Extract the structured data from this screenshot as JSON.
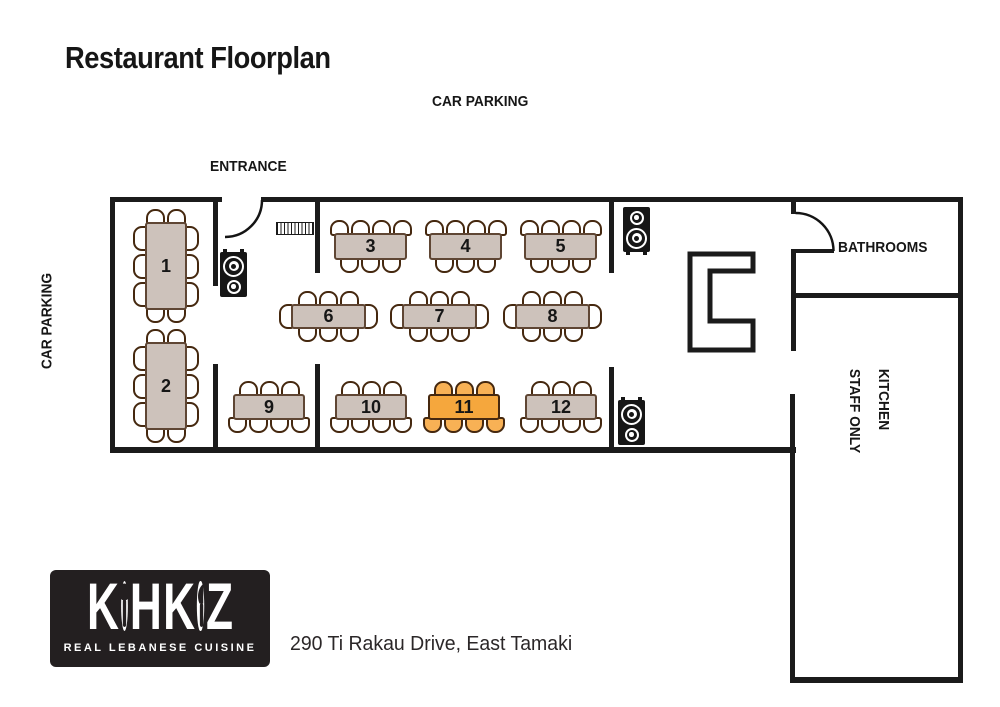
{
  "page": {
    "title": "Restaurant Floorplan",
    "address": "290 Ti Rakau Drive, East Tamaki"
  },
  "labels": {
    "car_parking_top": "CAR PARKING",
    "car_parking_left": "CAR PARKING",
    "entrance": "ENTRANCE",
    "bathrooms": "BATHROOMS",
    "bar": "BAR",
    "kitchen_line1": "KITCHEN",
    "kitchen_line2": "STAFF ONLY"
  },
  "logo": {
    "name": "KOHKOZ",
    "tagline": "REAL LEBANESE CUISINE"
  },
  "colors": {
    "wall": "#1b1b1b",
    "door_arc": "#141414",
    "table_fill": "#cdc2bb",
    "table_border": "#5f4634",
    "chair_fill": "#ffffff",
    "chair_border": "#45280f",
    "highlight_table_fill": "#f5a73d",
    "highlight_chair_fill": "#f8b155",
    "highlight_border": "#45280f",
    "speaker_bg": "#161616",
    "logo_bg": "#231f20",
    "text": "#1c1c1c"
  },
  "floorplan": {
    "tables": [
      {
        "label": "1",
        "x": 145,
        "y": 222,
        "w": 42,
        "h": 88,
        "seats": {
          "top": 2,
          "bottom": 2,
          "left": 3,
          "right": 3
        },
        "highlighted": false
      },
      {
        "label": "2",
        "x": 145,
        "y": 342,
        "w": 42,
        "h": 88,
        "seats": {
          "top": 2,
          "bottom": 2,
          "left": 3,
          "right": 3
        },
        "highlighted": false
      },
      {
        "label": "3",
        "x": 334,
        "y": 233,
        "w": 73,
        "h": 27,
        "seats": {
          "top": 4,
          "bottom": 3,
          "left": 0,
          "right": 0
        },
        "highlighted": false
      },
      {
        "label": "4",
        "x": 429,
        "y": 233,
        "w": 73,
        "h": 27,
        "seats": {
          "top": 4,
          "bottom": 3,
          "left": 0,
          "right": 0
        },
        "highlighted": false
      },
      {
        "label": "5",
        "x": 524,
        "y": 233,
        "w": 73,
        "h": 27,
        "seats": {
          "top": 4,
          "bottom": 3,
          "left": 0,
          "right": 0
        },
        "highlighted": false
      },
      {
        "label": "6",
        "x": 291,
        "y": 304,
        "w": 75,
        "h": 25,
        "seats": {
          "top": 3,
          "bottom": 3,
          "left": 1,
          "right": 1
        },
        "highlighted": false
      },
      {
        "label": "7",
        "x": 402,
        "y": 304,
        "w": 75,
        "h": 25,
        "seats": {
          "top": 3,
          "bottom": 3,
          "left": 1,
          "right": 1
        },
        "highlighted": false
      },
      {
        "label": "8",
        "x": 515,
        "y": 304,
        "w": 75,
        "h": 25,
        "seats": {
          "top": 3,
          "bottom": 3,
          "left": 1,
          "right": 1
        },
        "highlighted": false
      },
      {
        "label": "9",
        "x": 233,
        "y": 394,
        "w": 72,
        "h": 26,
        "seats": {
          "top": 3,
          "bottom": 4,
          "left": 0,
          "right": 0
        },
        "highlighted": false
      },
      {
        "label": "10",
        "x": 335,
        "y": 394,
        "w": 72,
        "h": 26,
        "seats": {
          "top": 3,
          "bottom": 4,
          "left": 0,
          "right": 0
        },
        "highlighted": false
      },
      {
        "label": "11",
        "x": 428,
        "y": 394,
        "w": 72,
        "h": 26,
        "seats": {
          "top": 3,
          "bottom": 4,
          "left": 0,
          "right": 0
        },
        "highlighted": true
      },
      {
        "label": "12",
        "x": 525,
        "y": 394,
        "w": 72,
        "h": 26,
        "seats": {
          "top": 3,
          "bottom": 4,
          "left": 0,
          "right": 0
        },
        "highlighted": false
      }
    ],
    "speakers": [
      {
        "x": 220,
        "y": 252,
        "variant": "big-top",
        "feet": "top"
      },
      {
        "x": 623,
        "y": 207,
        "variant": "big-bottom",
        "feet": "bottom"
      },
      {
        "x": 618,
        "y": 400,
        "variant": "big-top",
        "feet": "top"
      }
    ]
  }
}
